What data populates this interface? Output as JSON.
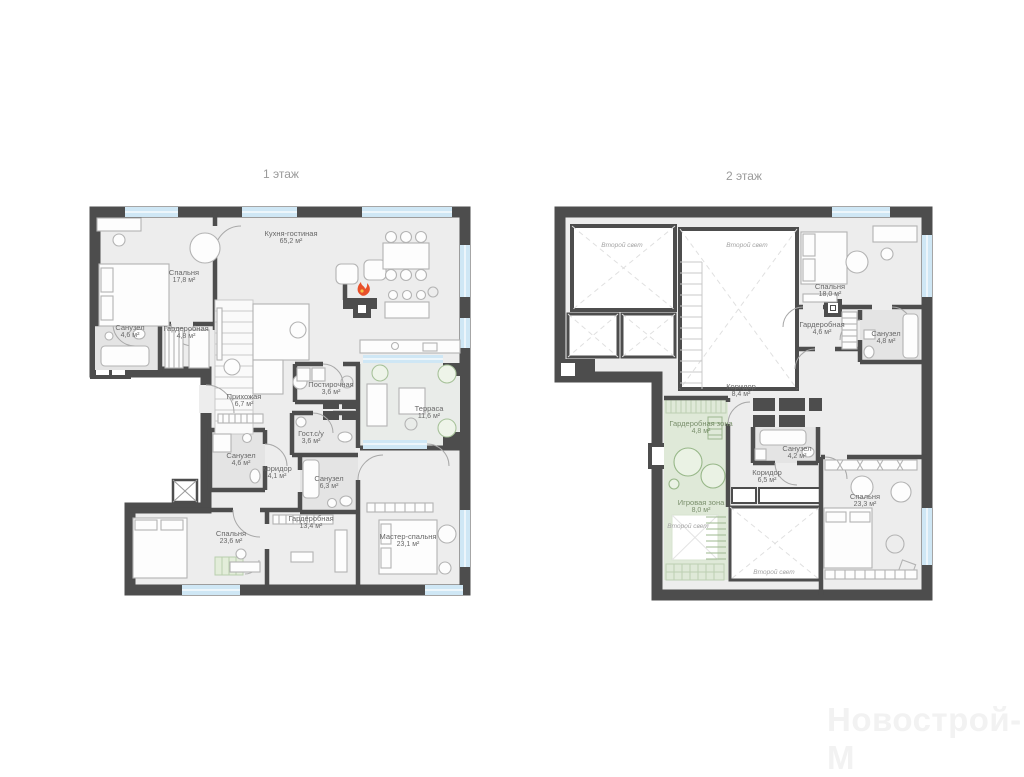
{
  "floor1": {
    "title": "1 этаж",
    "rooms": [
      {
        "name": "Спальня",
        "area": "17,8 м²"
      },
      {
        "name": "Кухня-гостиная",
        "area": "65,2 м²"
      },
      {
        "name": "Санузел",
        "area": "4,6 м²"
      },
      {
        "name": "Гардеробная",
        "area": "4,8 м²"
      },
      {
        "name": "Прихожая",
        "area": "6,7 м²"
      },
      {
        "name": "Постирочная",
        "area": "3,6 м²"
      },
      {
        "name": "Гост.с/у",
        "area": "3,6 м²"
      },
      {
        "name": "Терраса",
        "area": "11,6 м²"
      },
      {
        "name": "Санузел",
        "area": "4,6 м²"
      },
      {
        "name": "Коридор",
        "area": "4,1 м²"
      },
      {
        "name": "Санузел",
        "area": "6,3 м²"
      },
      {
        "name": "Гардеробная",
        "area": "13,4 м²"
      },
      {
        "name": "Спальня",
        "area": "23,6 м²"
      },
      {
        "name": "Мастер-спальня",
        "area": "23,1 м²"
      }
    ]
  },
  "floor2": {
    "title": "2 этаж",
    "void_label": "Второй свет",
    "rooms": [
      {
        "name": "Спальня",
        "area": "18,0 м²"
      },
      {
        "name": "Гардеробная",
        "area": "4,6 м²"
      },
      {
        "name": "Санузел",
        "area": "4,8 м²"
      },
      {
        "name": "Коридор",
        "area": "8,4 м²"
      },
      {
        "name": "Гардеробная зона",
        "area": "4,8 м²"
      },
      {
        "name": "Санузел",
        "area": "4,2 м²"
      },
      {
        "name": "Коридор",
        "area": "6,5 м²"
      },
      {
        "name": "Игровая зона",
        "area": "8,0 м²"
      },
      {
        "name": "Спальня",
        "area": "23,3 м²"
      }
    ]
  },
  "watermark": "Новострой-М",
  "colors": {
    "wall": "#4d4d4d",
    "floor": "#ededed",
    "window": "#cfe7f5",
    "green_zone": "#dfe9d8",
    "flame": "#e8502a"
  }
}
